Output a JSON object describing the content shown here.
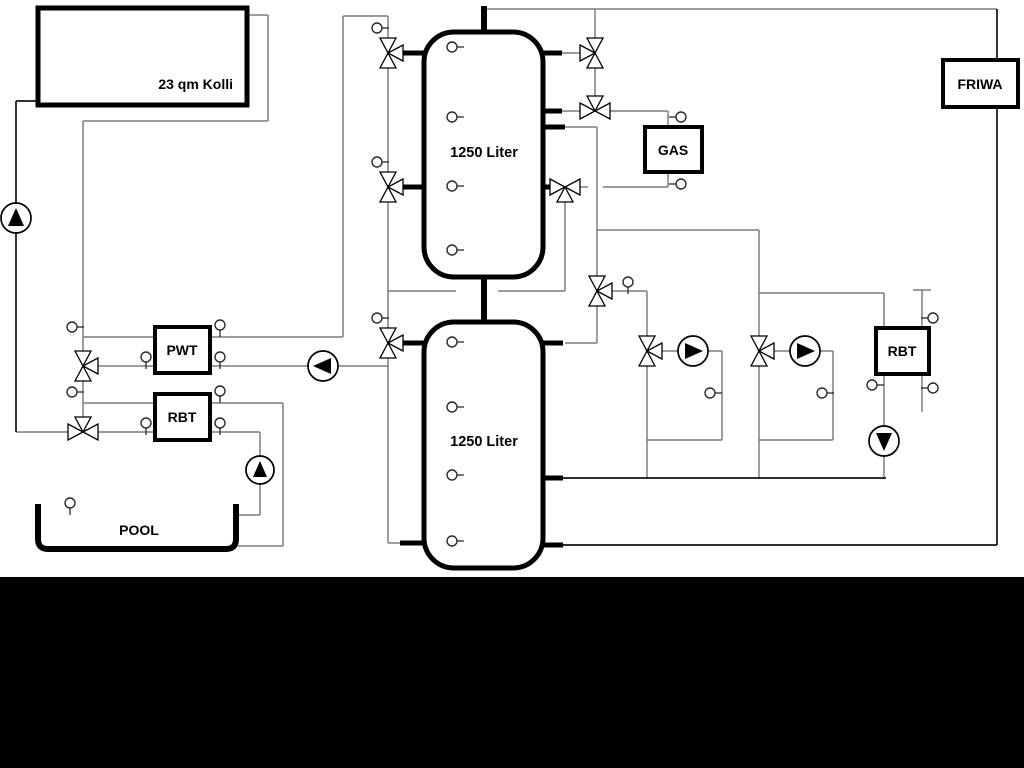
{
  "colors": {
    "background": "#ffffff",
    "bottom_band": "#000000",
    "pipe_gray": "#7d7d7d",
    "pipe_black": "#121212",
    "component_stroke": "#000000",
    "component_fill": "#ffffff"
  },
  "labels": [
    {
      "id": "collector",
      "text": "23 qm Kolli",
      "x": 233,
      "y": 89,
      "anchor": "end",
      "size": 14
    },
    {
      "id": "tank1",
      "text": "1250 Liter",
      "x": 484,
      "y": 157,
      "anchor": "middle",
      "size": 14.5
    },
    {
      "id": "tank2",
      "text": "1250 Liter",
      "x": 484,
      "y": 446,
      "anchor": "middle",
      "size": 14.5
    },
    {
      "id": "gas",
      "text": "GAS",
      "x": 673,
      "y": 155,
      "anchor": "middle",
      "size": 14
    },
    {
      "id": "friwa",
      "text": "FRIWA",
      "x": 980,
      "y": 89,
      "anchor": "middle",
      "size": 14
    },
    {
      "id": "pwt",
      "text": "PWT",
      "x": 182,
      "y": 355,
      "anchor": "middle",
      "size": 14
    },
    {
      "id": "rbt_left",
      "text": "RBT",
      "x": 182,
      "y": 422,
      "anchor": "middle",
      "size": 14
    },
    {
      "id": "rbt_right",
      "text": "RBT",
      "x": 902,
      "y": 356,
      "anchor": "middle",
      "size": 14
    },
    {
      "id": "pool",
      "text": "POOL",
      "x": 139,
      "y": 535,
      "anchor": "middle",
      "size": 14
    }
  ],
  "boxes": [
    {
      "name": "solar-collector-box",
      "x": 38,
      "y": 8,
      "w": 209,
      "h": 97,
      "stroke_w": 5
    },
    {
      "name": "gas-boiler-box",
      "x": 645,
      "y": 127,
      "w": 57,
      "h": 45,
      "stroke_w": 4
    },
    {
      "name": "friwa-station-box",
      "x": 943,
      "y": 60,
      "w": 75,
      "h": 47,
      "stroke_w": 4
    },
    {
      "name": "pwt-heat-exchanger-box",
      "x": 155,
      "y": 327,
      "w": 55,
      "h": 46,
      "stroke_w": 4
    },
    {
      "name": "rbt-pool-heat-exchanger-box",
      "x": 155,
      "y": 394,
      "w": 55,
      "h": 46,
      "stroke_w": 4
    },
    {
      "name": "rbt-heating-heat-exchanger-box",
      "x": 876,
      "y": 328,
      "w": 53,
      "h": 46,
      "stroke_w": 4
    }
  ],
  "tanks": [
    {
      "name": "buffer-tank-1",
      "x": 424,
      "y": 32,
      "w": 119,
      "h": 245,
      "rx": 30,
      "stroke_w": 5
    },
    {
      "name": "buffer-tank-2",
      "x": 424,
      "y": 322,
      "w": 119,
      "h": 246,
      "rx": 30,
      "stroke_w": 5
    }
  ],
  "pool_path": "M38,504 L38,539 Q38,549 48,549 L226,549 Q236,549 236,539 L236,504",
  "pipes_gray": [
    [
      483,
      9,
      997,
      9
    ],
    [
      595,
      9,
      595,
      38
    ],
    [
      595,
      68,
      595,
      96
    ],
    [
      562,
      53,
      580,
      53
    ],
    [
      562,
      111,
      580,
      111
    ],
    [
      610,
      111,
      668,
      111
    ],
    [
      668,
      111,
      668,
      127
    ],
    [
      668,
      172,
      668,
      187
    ],
    [
      603,
      187,
      668,
      187
    ],
    [
      580,
      187,
      588,
      187
    ],
    [
      565,
      127,
      597,
      127
    ],
    [
      597,
      127,
      597,
      276
    ],
    [
      597,
      306,
      597,
      343
    ],
    [
      565,
      343,
      597,
      343
    ],
    [
      597,
      230,
      759,
      230
    ],
    [
      759,
      230,
      759,
      336
    ],
    [
      612,
      291,
      647,
      291
    ],
    [
      647,
      291,
      647,
      336
    ],
    [
      759,
      293,
      884,
      293
    ],
    [
      884,
      293,
      884,
      328
    ],
    [
      647,
      366,
      647,
      478
    ],
    [
      647,
      440,
      722,
      440
    ],
    [
      722,
      351,
      722,
      440
    ],
    [
      662,
      351,
      678,
      351
    ],
    [
      708,
      351,
      722,
      351
    ],
    [
      759,
      366,
      759,
      478
    ],
    [
      759,
      440,
      833,
      440
    ],
    [
      833,
      351,
      833,
      440
    ],
    [
      774,
      351,
      790,
      351
    ],
    [
      820,
      351,
      833,
      351
    ],
    [
      884,
      374,
      884,
      426
    ],
    [
      884,
      456,
      884,
      478
    ],
    [
      913,
      290,
      931,
      290
    ],
    [
      922,
      290,
      922,
      328
    ],
    [
      922,
      374,
      922,
      412
    ],
    [
      247,
      15,
      268,
      15
    ],
    [
      268,
      15,
      268,
      121
    ],
    [
      83,
      121,
      268,
      121
    ],
    [
      83,
      121,
      83,
      351
    ],
    [
      83,
      381,
      83,
      417
    ],
    [
      83,
      337,
      155,
      337
    ],
    [
      210,
      337,
      343,
      337
    ],
    [
      343,
      16,
      343,
      337
    ],
    [
      343,
      16,
      388,
      16
    ],
    [
      388,
      16,
      388,
      38
    ],
    [
      98,
      366,
      155,
      366
    ],
    [
      210,
      366,
      308,
      366
    ],
    [
      338,
      366,
      388,
      366
    ],
    [
      388,
      68,
      388,
      172
    ],
    [
      388,
      202,
      388,
      328
    ],
    [
      388,
      358,
      388,
      543
    ],
    [
      388,
      543,
      402,
      543
    ],
    [
      388,
      291,
      456,
      291
    ],
    [
      498,
      291,
      565,
      291
    ],
    [
      565,
      202,
      565,
      291
    ],
    [
      83,
      403,
      155,
      403
    ],
    [
      210,
      403,
      283,
      403
    ],
    [
      283,
      403,
      283,
      546
    ],
    [
      238,
      546,
      283,
      546
    ],
    [
      98,
      432,
      155,
      432
    ],
    [
      210,
      432,
      260,
      432
    ],
    [
      260,
      432,
      260,
      456
    ],
    [
      260,
      484,
      260,
      515
    ],
    [
      234,
      515,
      260,
      515
    ],
    [
      16,
      432,
      68,
      432
    ]
  ],
  "pipes_black": [
    [
      16,
      101,
      38,
      101
    ],
    [
      16,
      101,
      16,
      432
    ],
    [
      563,
      478,
      886,
      478
    ],
    [
      563,
      545,
      997,
      545
    ],
    [
      997,
      9,
      997,
      545
    ]
  ],
  "stubs": [
    [
      484,
      6,
      484,
      34,
      6
    ],
    [
      484,
      275,
      484,
      324,
      6
    ],
    [
      402,
      53,
      426,
      53,
      5
    ],
    [
      402,
      187,
      426,
      187,
      5
    ],
    [
      541,
      53,
      562,
      53,
      5
    ],
    [
      541,
      111,
      562,
      111,
      5
    ],
    [
      541,
      127,
      565,
      127,
      5
    ],
    [
      541,
      187,
      552,
      187,
      5
    ],
    [
      402,
      343,
      426,
      343,
      5
    ],
    [
      400,
      543,
      426,
      543,
      5
    ],
    [
      541,
      343,
      563,
      343,
      5
    ],
    [
      541,
      478,
      563,
      478,
      5
    ],
    [
      541,
      545,
      563,
      545,
      5
    ]
  ],
  "valves": [
    {
      "x": 388,
      "y": 53,
      "ports": "tbr"
    },
    {
      "x": 388,
      "y": 187,
      "ports": "tbr"
    },
    {
      "x": 388,
      "y": 343,
      "ports": "tbr"
    },
    {
      "x": 83,
      "y": 366,
      "ports": "tbr"
    },
    {
      "x": 83,
      "y": 432,
      "ports": "lrt"
    },
    {
      "x": 595,
      "y": 53,
      "ports": "tbl"
    },
    {
      "x": 595,
      "y": 111,
      "ports": "lrt"
    },
    {
      "x": 565,
      "y": 187,
      "ports": "lrb"
    },
    {
      "x": 597,
      "y": 291,
      "ports": "tbr"
    },
    {
      "x": 647,
      "y": 351,
      "ports": "tbr"
    },
    {
      "x": 759,
      "y": 351,
      "ports": "tbr"
    }
  ],
  "pumps": [
    {
      "x": 16,
      "y": 218,
      "r": 15,
      "dir": "up"
    },
    {
      "x": 323,
      "y": 366,
      "r": 15,
      "dir": "left"
    },
    {
      "x": 260,
      "y": 470,
      "r": 14,
      "dir": "up"
    },
    {
      "x": 693,
      "y": 351,
      "r": 15,
      "dir": "right"
    },
    {
      "x": 805,
      "y": 351,
      "r": 15,
      "dir": "right"
    },
    {
      "x": 884,
      "y": 441,
      "r": 15,
      "dir": "down"
    }
  ],
  "sensors": [
    {
      "x": 233,
      "y": 21,
      "stub": "l"
    },
    {
      "x": 49,
      "y": 58,
      "stub": "r"
    },
    {
      "x": 452,
      "y": 47,
      "stub": "r"
    },
    {
      "x": 452,
      "y": 117,
      "stub": "r"
    },
    {
      "x": 452,
      "y": 186,
      "stub": "r"
    },
    {
      "x": 452,
      "y": 250,
      "stub": "r"
    },
    {
      "x": 452,
      "y": 342,
      "stub": "r"
    },
    {
      "x": 452,
      "y": 407,
      "stub": "r"
    },
    {
      "x": 452,
      "y": 475,
      "stub": "r"
    },
    {
      "x": 452,
      "y": 541,
      "stub": "r"
    },
    {
      "x": 377,
      "y": 28,
      "stub": "r"
    },
    {
      "x": 377,
      "y": 162,
      "stub": "r"
    },
    {
      "x": 377,
      "y": 318,
      "stub": "r"
    },
    {
      "x": 72,
      "y": 327,
      "stub": "r"
    },
    {
      "x": 72,
      "y": 392,
      "stub": "r"
    },
    {
      "x": 146,
      "y": 357,
      "stub": "d"
    },
    {
      "x": 220,
      "y": 325,
      "stub": "d"
    },
    {
      "x": 220,
      "y": 357,
      "stub": "d"
    },
    {
      "x": 146,
      "y": 423,
      "stub": "d"
    },
    {
      "x": 220,
      "y": 391,
      "stub": "d"
    },
    {
      "x": 220,
      "y": 423,
      "stub": "d"
    },
    {
      "x": 70,
      "y": 503,
      "stub": "d"
    },
    {
      "x": 681,
      "y": 117,
      "stub": "l"
    },
    {
      "x": 681,
      "y": 184,
      "stub": "l"
    },
    {
      "x": 628,
      "y": 282,
      "stub": "d"
    },
    {
      "x": 710,
      "y": 393,
      "stub": "r"
    },
    {
      "x": 822,
      "y": 393,
      "stub": "r"
    },
    {
      "x": 872,
      "y": 385,
      "stub": "r"
    },
    {
      "x": 933,
      "y": 318,
      "stub": "l"
    },
    {
      "x": 933,
      "y": 388,
      "stub": "l"
    }
  ],
  "bottom_band": {
    "x": 0,
    "y": 577,
    "w": 1024,
    "h": 191
  }
}
